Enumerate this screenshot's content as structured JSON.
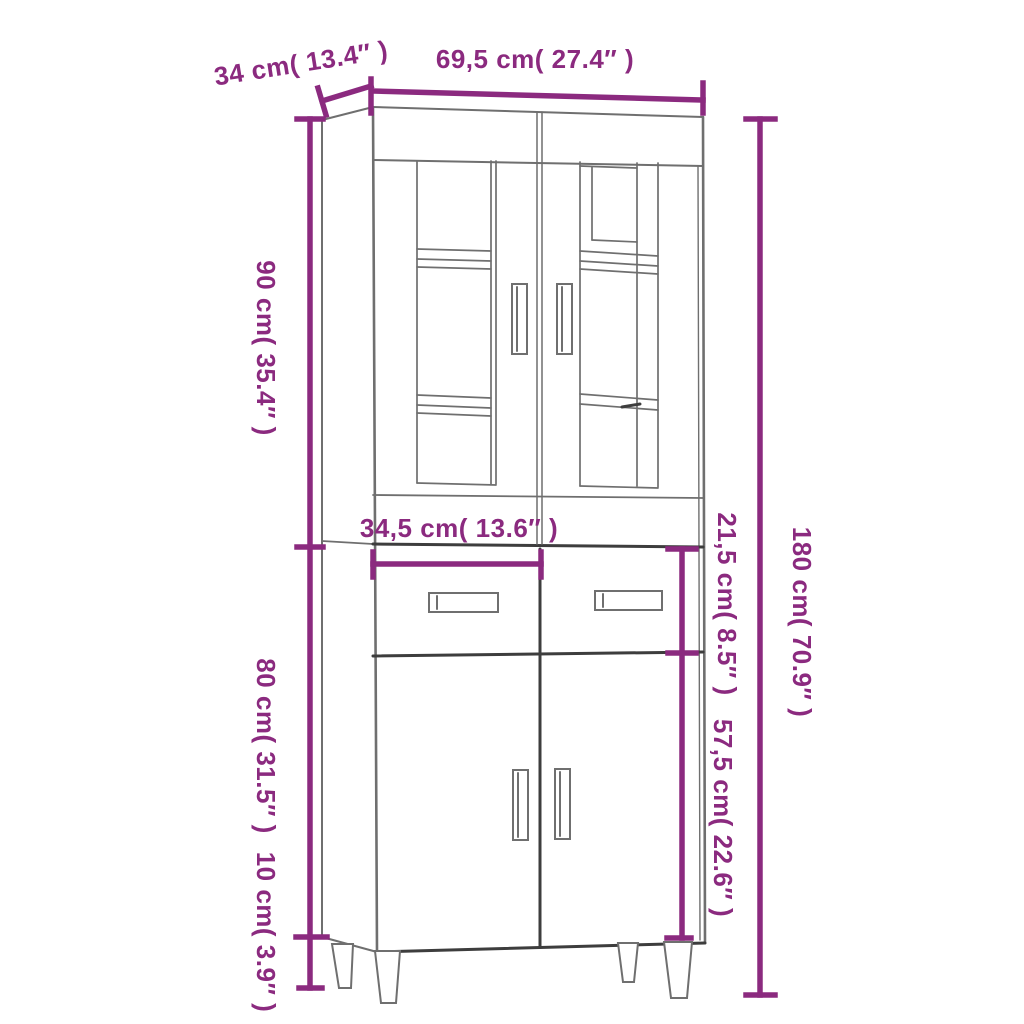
{
  "page": {
    "background": "#ffffff"
  },
  "diagram": {
    "type": "furniture-dimension-diagram",
    "product": "highboard-cabinet-line-drawing",
    "accent_color": "#8B2A7F",
    "outline_color": "#6f6f6f",
    "outline_dark_color": "#3d3d3d",
    "dimensions": {
      "depth": {
        "cm": 34,
        "in": 13.4,
        "label": "34 cm( 13.4″ )"
      },
      "width": {
        "cm": 69.5,
        "in": 27.4,
        "label": "69,5 cm( 27.4″ )"
      },
      "upper_height": {
        "cm": 90,
        "in": 35.4,
        "label": "90 cm( 35.4″ )"
      },
      "total_height": {
        "cm": 180,
        "in": 70.9,
        "label": "180 cm( 70.9″ )"
      },
      "drawer_width": {
        "cm": 34.5,
        "in": 13.6,
        "label": "34,5 cm( 13.6″ )"
      },
      "drawer_height": {
        "cm": 21.5,
        "in": 8.5,
        "label": "21,5 cm( 8.5″ )"
      },
      "lower_height": {
        "cm": 80,
        "in": 31.5,
        "label": "80 cm( 31.5″ )"
      },
      "door_height": {
        "cm": 57.5,
        "in": 22.6,
        "label": "57,5 cm( 22.6″ )"
      },
      "leg_height": {
        "cm": 10,
        "in": 3.9,
        "label": "10 cm( 3.9″ )"
      }
    }
  }
}
